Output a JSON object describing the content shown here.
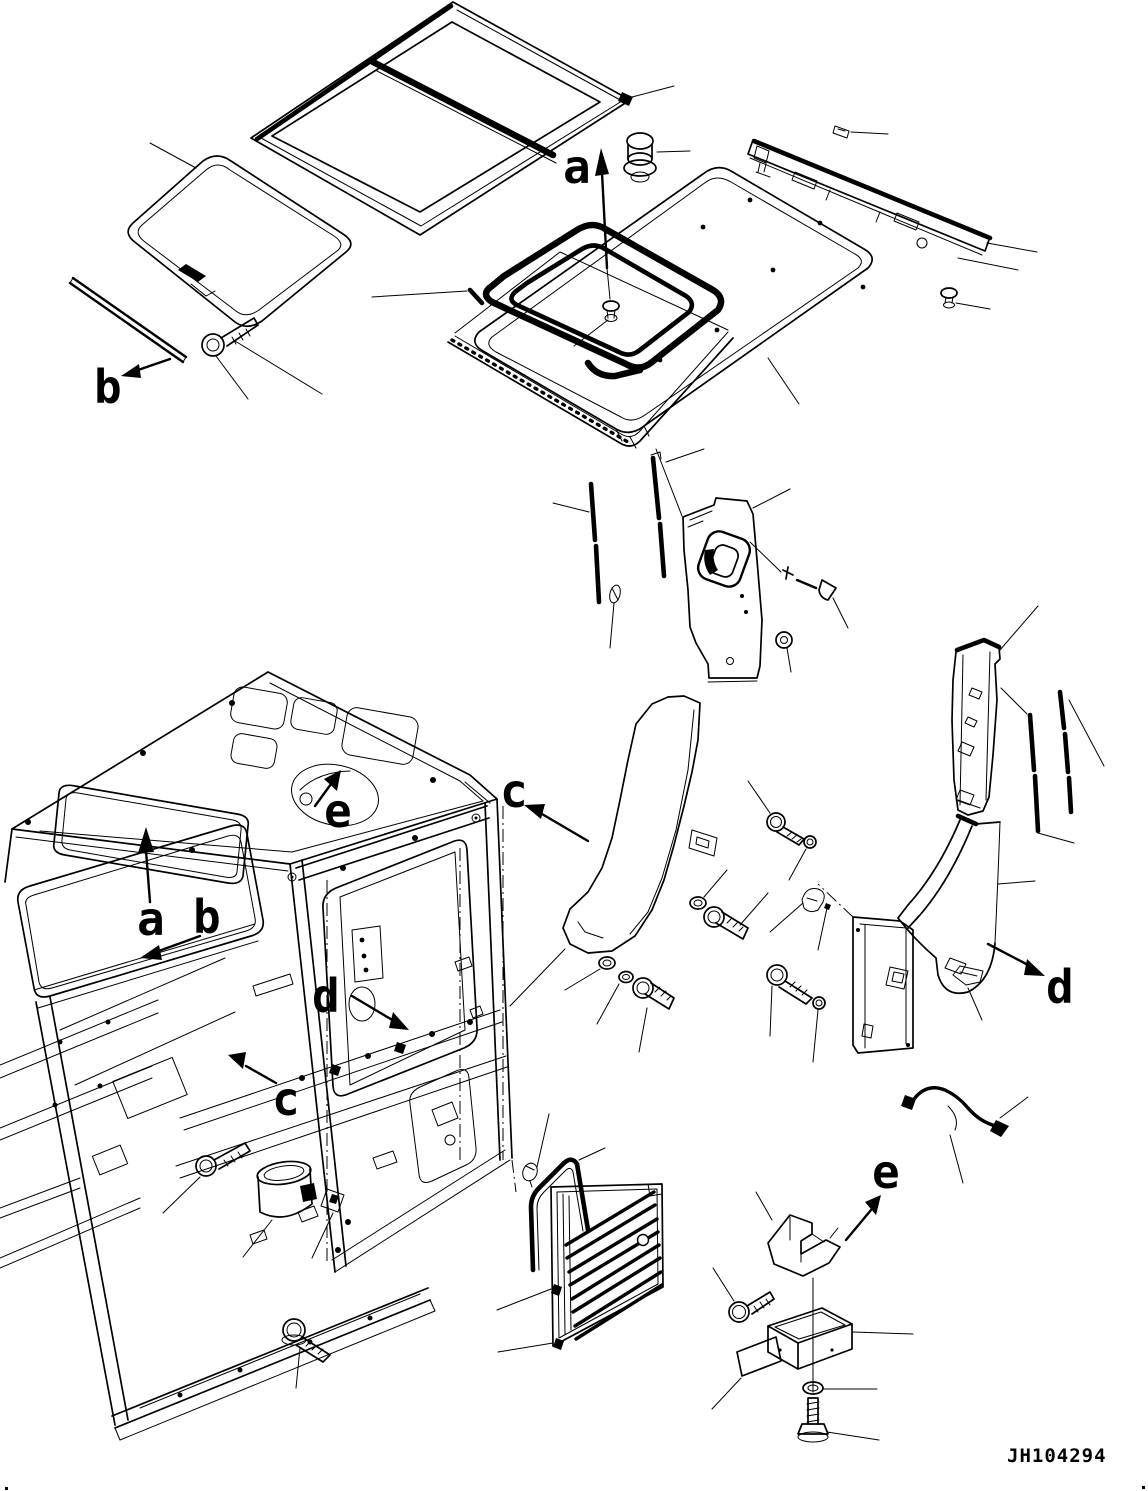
{
  "diagram": {
    "drawing_number": "JH104294",
    "labels": {
      "top_a": "a",
      "top_b": "b",
      "cab_a": "a",
      "cab_b": "b",
      "cab_c": "c",
      "cab_d": "d",
      "cab_e": "e",
      "view_c": "c",
      "view_d": "d",
      "view_e": "e"
    }
  }
}
